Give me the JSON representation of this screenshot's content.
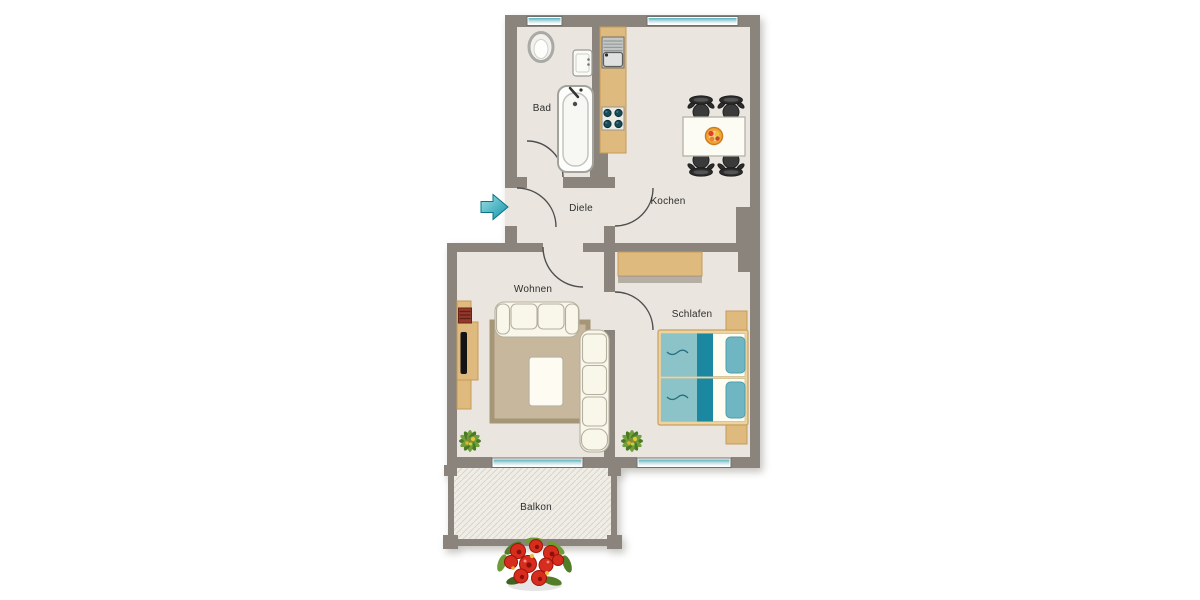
{
  "rooms": {
    "bad": {
      "label": "Bad"
    },
    "diele": {
      "label": "Diele"
    },
    "kochen": {
      "label": "Kochen"
    },
    "wohnen": {
      "label": "Wohnen"
    },
    "schlafen": {
      "label": "Schlafen"
    },
    "balkon": {
      "label": "Balkon"
    }
  },
  "icons": {
    "entrance_arrow": "right-arrow-entrance",
    "corner_plant": "potted-plant",
    "balcony_flowers": "flower-box"
  },
  "colors": {
    "wall": "#8a847c",
    "floor": "#eae6df",
    "balconyFloor": "#efede6",
    "hatch": "#d9d4ca",
    "wood": "#dfba7e",
    "woodEdge": "#c49a57",
    "rug": "#c7b79c",
    "rugEdge": "#a69678",
    "upholstery": "#f9f6ea",
    "upholsteryEdge": "#b5b09e",
    "bedLight": "#8cc3c9",
    "bedDark": "#1b87a0",
    "pillow": "#6fb6c2",
    "bedFrame": "#ecd4a0",
    "chair": "#333333",
    "windowTeal": "#5fb3c0",
    "arrowTeal": "#1795a9",
    "flowerRed": "#d62d1f",
    "leafGreen": "#5c832e",
    "labelInk": "#2e2e2e"
  }
}
